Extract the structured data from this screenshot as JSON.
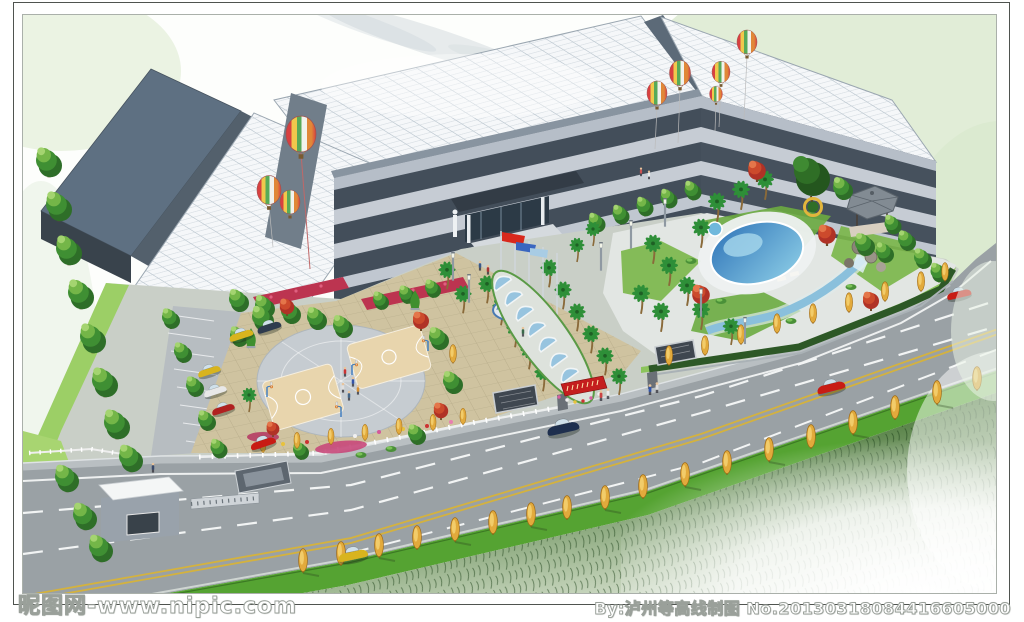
{
  "watermark": {
    "left": "昵图网-www.nipic.com",
    "right": "By:泸州等高线制图 No.20130318084416605000"
  },
  "scene_objects": [
    "factory-office-building-complex",
    "white-grid-skylight-roofs",
    "dark-warehouse-roofs",
    "hot-air-balloons",
    "entrance-canopy",
    "flag-poles",
    "arched-sculpture-walkway",
    "circular-basketball-courts",
    "parking-lot",
    "landscaped-garden",
    "swimming-pool",
    "pavilion",
    "rockery-stream",
    "gate-house",
    "retractable-gate",
    "avenue-road",
    "median-green-strip",
    "golden-poplar-trees",
    "palm-trees",
    "red-maple-trees",
    "cars",
    "pedestrians"
  ],
  "colors": {
    "frame_border": "#4f534f",
    "sky_wash": "#d7e7cb",
    "roof_white": "#f5f7f9",
    "roof_dark": "#5e7082",
    "facade": "#434e5a",
    "window_band": "#c6ccd4",
    "site_base": "#c9cfc7",
    "paving_tan": "#cfc3a0",
    "paving_grey": "#c6ccd1",
    "road": "#9aa1a5",
    "road_line_yellow": "#d4b23e",
    "median_grass": "#55a332",
    "bank_green": "#2f5a28",
    "tree_green": "#3f8f33",
    "tree_yellow": "#e2aa3c",
    "tree_red": "#c04030",
    "pool_water": "#4a90c8",
    "flag_red": "#d8281c",
    "flag_blue": "#3a66c0",
    "banner_red": "#c41e1e",
    "car_red": "#c81c14",
    "car_yellow": "#d8b41e",
    "car_dark": "#1e2f4e",
    "watermark_text": "#ffffff"
  }
}
